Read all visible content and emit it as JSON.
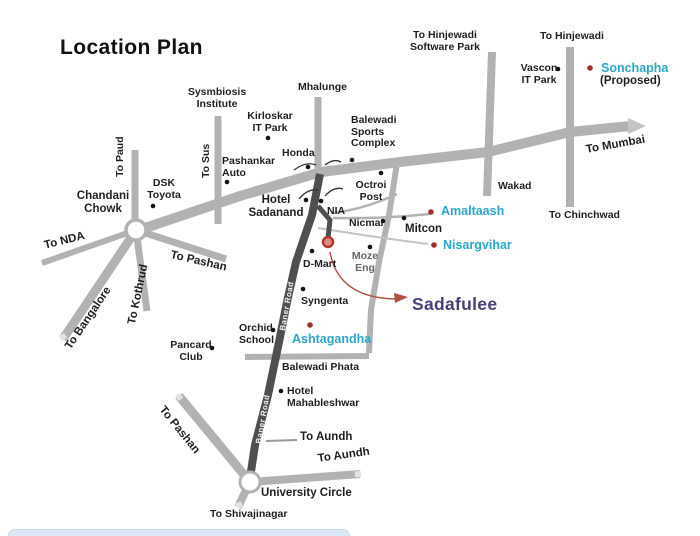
{
  "title": "Location Plan",
  "colors": {
    "road": "#b2b2b2",
    "baner_road_dark": "#4f4f4f",
    "project_teal": "#2ba6c9",
    "marker_red": "#9e312b",
    "sadafulee_purple": "#464278",
    "arrow_red": "#b15043",
    "label_text": "#1f1f1f"
  },
  "labels": {
    "sysmbiosis_institute": "Sysmbiosis\nInstitute",
    "kirloskar_it_park": "Kirloskar\nIT Park",
    "mhalunge": "Mhalunge",
    "to_hinjewadi_software_park": "To Hinjewadi\nSoftware Park",
    "to_hinjewadi": "To Hinjewadi",
    "vascon_it_park": "Vascon\nIT Park",
    "sonchapha": "Sonchapha",
    "sonchapha_proposed": "(Proposed)",
    "to_mumbai": "To Mumbai",
    "wakad": "Wakad",
    "to_chinchwad": "To Chinchwad",
    "balewadi_sports_complex": "Balewadi\nSports\nComplex",
    "honda": "Honda",
    "pashankar_auto": "Pashankar\nAuto",
    "to_sus": "To Sus",
    "to_paud": "To Paud",
    "dsk_toyota": "DSK\nToyota",
    "chandani_chowk": "Chandani\nChowk",
    "to_nda": "To NDA",
    "to_pashan_upper": "To Pashan",
    "to_kothrud": "To Kothrud",
    "to_bangalore": "To Bangalore",
    "octroi_post": "Octroi\nPost",
    "hotel_sadanand": "Hotel\nSadanand",
    "nia": "NIA",
    "nicmar": "Nicmar",
    "mitcon": "Mitcon",
    "amaltaash": "Amaltaash",
    "nisargvihar": "Nisargvihar",
    "moze_eng": "Moze\nEng",
    "d_mart": "D-Mart",
    "syngenta": "Syngenta",
    "sadafulee": "Sadafulee",
    "ashtagandha": "Ashtagandha",
    "orchid_school": "Orchid\nSchool",
    "pancard_club": "Pancard\nClub",
    "balewadi_phata": "Balewadi Phata",
    "hotel_mahableshwar": "Hotel\nMahableshwar",
    "to_aundh_spur": "To Aundh",
    "to_aundh_road": "To Aundh",
    "university_circle": "University Circle",
    "to_shivajinagar": "To Shivajinagar",
    "to_pashan_lower": "To Pashan",
    "baner_road": "Baner Road"
  },
  "projects_marked_red": [
    "Sonchapha (Proposed)",
    "Amaltaash",
    "Nisargvihar",
    "Ashtagandha",
    "Sadafulee"
  ]
}
